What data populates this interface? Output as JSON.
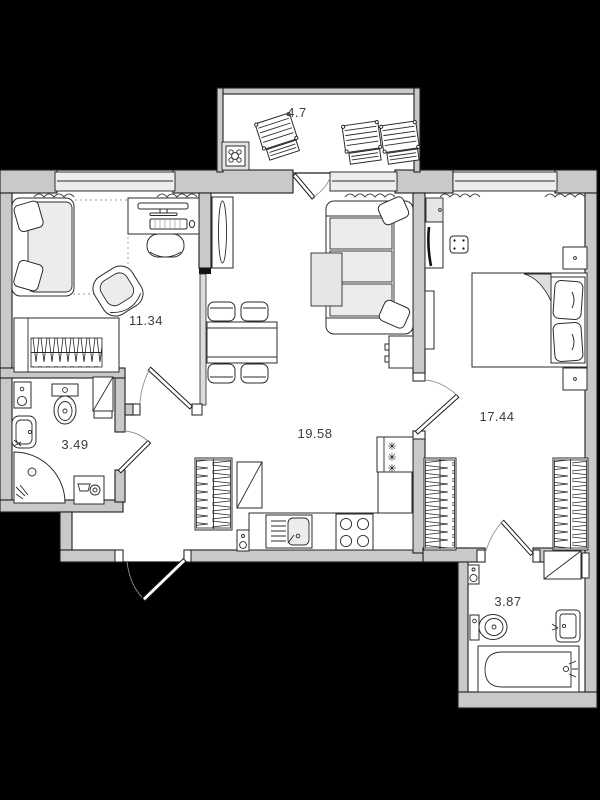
{
  "floor_plan": {
    "rooms": [
      {
        "name": "balcony",
        "area_label": "4.7"
      },
      {
        "name": "room-small",
        "area_label": "11.34"
      },
      {
        "name": "living-kitchen",
        "area_label": "19.58"
      },
      {
        "name": "bedroom-master",
        "area_label": "17.44"
      },
      {
        "name": "bathroom-left",
        "area_label": "3.49"
      },
      {
        "name": "bathroom-right",
        "area_label": "3.87"
      }
    ],
    "colors": {
      "background": "#000000",
      "wall_fill": "#c9c9c9",
      "window_fill": "#ededed",
      "interior_fill": "#ffffff",
      "soft_furniture_fill": "#ececec",
      "outline": "#1c1c1c",
      "label_text": "#3c3c3c"
    }
  }
}
